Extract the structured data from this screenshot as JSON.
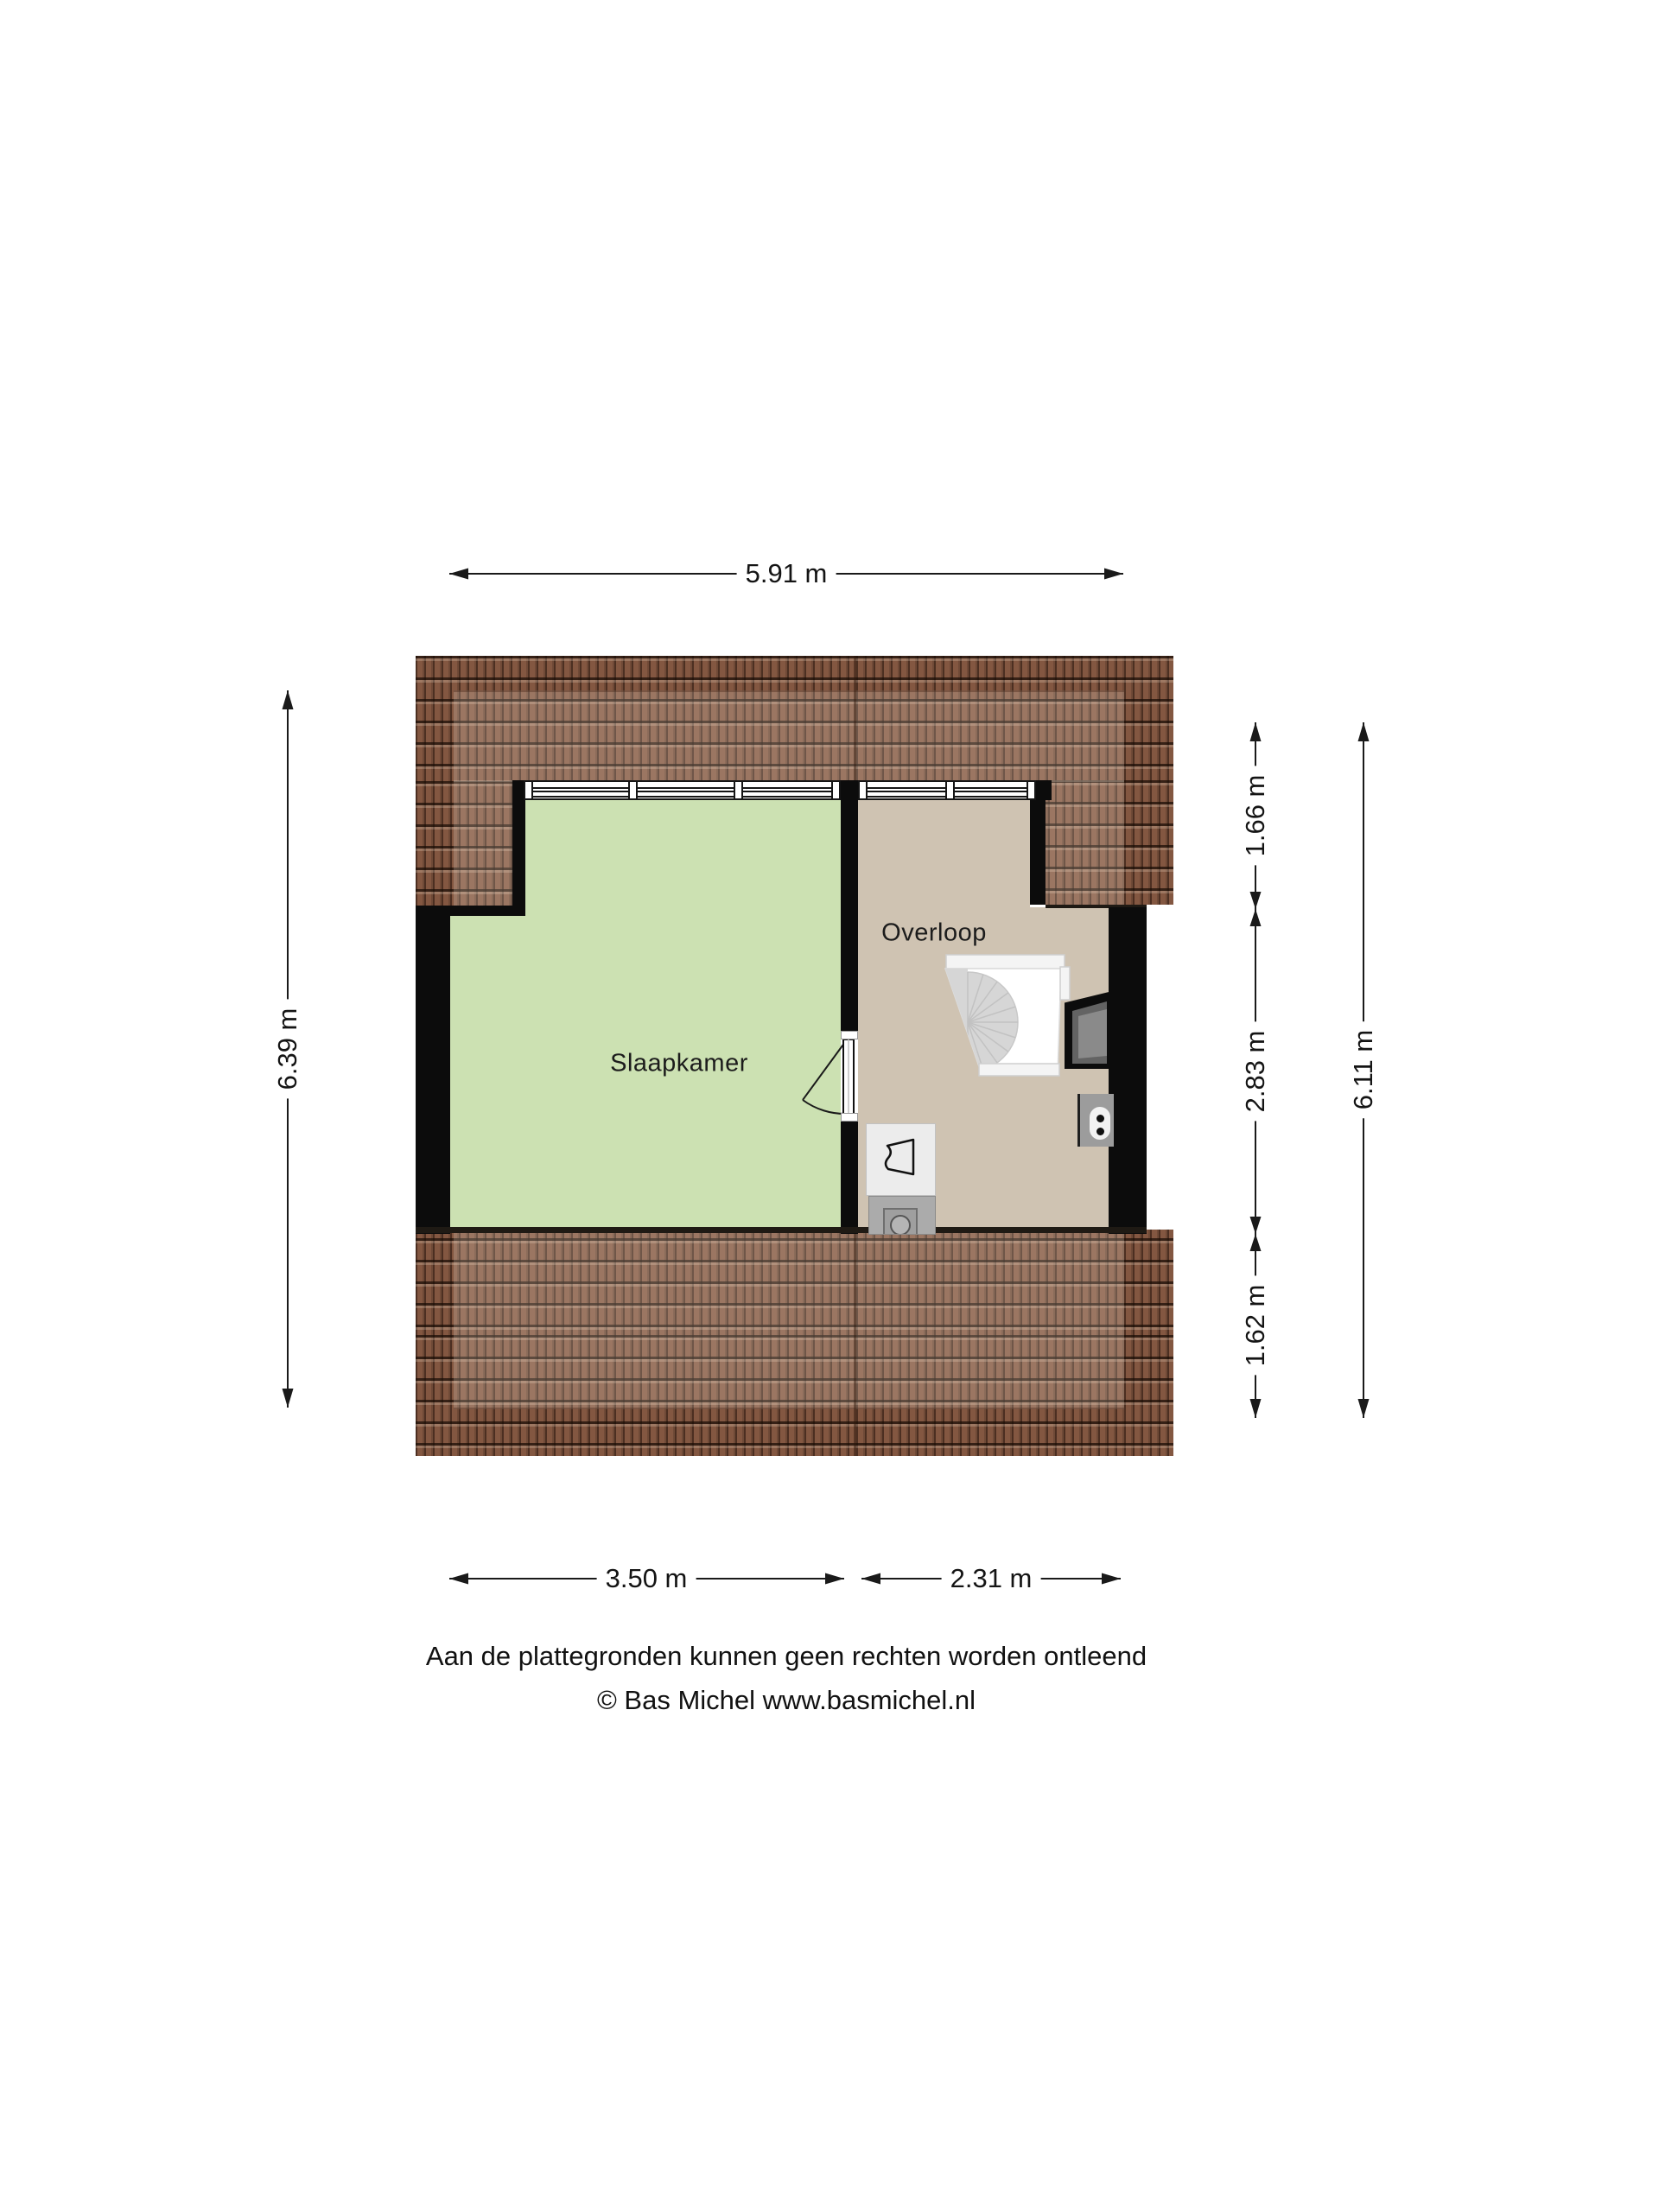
{
  "floorplan": {
    "type": "attic floor plan",
    "rooms": [
      {
        "id": "slaapkamer",
        "label": "Slaapkamer",
        "floor_color": "#cce1b2"
      },
      {
        "id": "overloop",
        "label": "Overloop",
        "floor_color": "#cfc3b2"
      }
    ],
    "features": [
      "roof-tiles",
      "spiral-staircase",
      "roof-window-panel",
      "power-outlet",
      "sink-unit",
      "washing-machine",
      "door-swing",
      "window-band"
    ],
    "colors": {
      "roof_tile": "#835741",
      "wall": "#0c0c0c",
      "background": "#ffffff",
      "stair": "#d6d6d6"
    }
  },
  "dimensions": {
    "top_width": "5.91 m",
    "left_height": "6.39 m",
    "right_segments": [
      "1.66 m",
      "2.83 m",
      "1.62 m"
    ],
    "right_total": "6.11 m",
    "bottom_left_width": "3.50 m",
    "bottom_right_width": "2.31 m"
  },
  "footer": {
    "disclaimer": "Aan de plattegronden kunnen geen rechten worden ontleend",
    "credit": "© Bas Michel www.basmichel.nl"
  }
}
